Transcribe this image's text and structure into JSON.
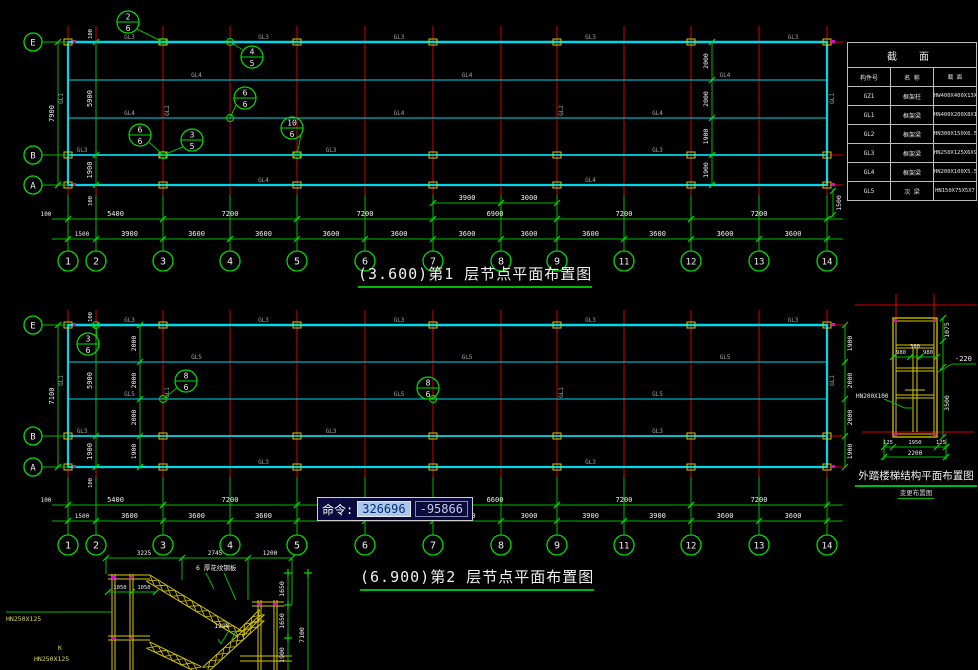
{
  "colors": {
    "grid_red": "#d40000",
    "beam_cyan": "#00d8e8",
    "dim_green": "#00bb00",
    "tick_green": "#00e000",
    "text_white": "#f0f0f0",
    "label_gray": "#a2a2a2",
    "column_yellow": "#d8c800",
    "magenta": "#e000e0",
    "cmd_bg": "#0a0a3e",
    "cmd_select_bg": "#a9c9ea"
  },
  "command_bar": {
    "prompt": "命令:",
    "value_x": "326696",
    "value_y": "-95866"
  },
  "section_table": {
    "title": "截 面",
    "headers": [
      "构件号",
      "名 称",
      "截 面"
    ],
    "rows": [
      [
        "GZ1",
        "框架柱",
        "HW400X400X13X21"
      ],
      [
        "GL1",
        "框架梁",
        "HN400X200X8X13"
      ],
      [
        "GL2",
        "框架梁",
        "HN300X150X6.5X9"
      ],
      [
        "GL3",
        "框架梁",
        "HN250X125X6X9"
      ],
      [
        "GL4",
        "框架梁",
        "HN200X100X5.5X8"
      ],
      [
        "GL5",
        "次 梁",
        "HN150X75X5X7"
      ]
    ]
  },
  "plans": [
    {
      "id": "plan1",
      "title_elevation": "(3.600)",
      "title_text": "第1 层节点平面布置图",
      "axis_labels": [
        "1",
        "2",
        "3",
        "4",
        "5",
        "6",
        "7",
        "8",
        "9",
        "11",
        "12",
        "13",
        "14"
      ],
      "axes_x": [
        68,
        96,
        163,
        230,
        297,
        365,
        433,
        501,
        557,
        624,
        691,
        759,
        827
      ],
      "rows_y": [
        42,
        80,
        118,
        155,
        185
      ],
      "row_labels": [
        {
          "label": "E",
          "row": 0
        },
        {
          "label": "B",
          "row": 3
        },
        {
          "label": "A",
          "row": 4
        }
      ],
      "dims_lower": [
        "1500",
        "3900",
        "3600",
        "3600",
        "3600",
        "3600",
        "3600",
        "3600",
        "3600",
        "3600",
        "3600",
        "3600"
      ],
      "dims_upper": [
        {
          "a": 0,
          "b": 2,
          "t": "5400"
        },
        {
          "a": 2,
          "b": 4,
          "t": "7200"
        },
        {
          "a": 4,
          "b": 6,
          "t": "7200"
        },
        {
          "a": 6,
          "b": 8,
          "t": "6900"
        },
        {
          "a": 8,
          "b": 10,
          "t": "7200"
        },
        {
          "a": 10,
          "b": 12,
          "t": "7200"
        }
      ],
      "dims_extra": [
        {
          "a": 6,
          "b": 7,
          "t": "3900"
        },
        {
          "a": 7,
          "b": 8,
          "t": "3000"
        }
      ],
      "left_total": "7900",
      "left_segs": [
        "5900",
        "1900"
      ],
      "margin_top": "100",
      "margin_bottom": "100",
      "inner_chain": {
        "x": 712,
        "labels": [
          "2000",
          "2000",
          "1900",
          "1900"
        ]
      },
      "right_chain": null,
      "right_below": "1500",
      "beam_top": "GL3",
      "beam_mid": "GL4",
      "beam_b": "GL3",
      "beam_a": "GL4",
      "beam_edge": "GL1",
      "beam_grid": "GL2",
      "column_mark": "GZ1",
      "callouts": [
        {
          "x": 128,
          "y": 22,
          "n": "2",
          "d": "6",
          "tx": 163,
          "ty": 42
        },
        {
          "x": 252,
          "y": 57,
          "n": "4",
          "d": "5",
          "tx": 230,
          "ty": 42
        },
        {
          "x": 245,
          "y": 98,
          "n": "6",
          "d": "6",
          "tx": 230,
          "ty": 118
        },
        {
          "x": 292,
          "y": 128,
          "n": "10",
          "d": "6",
          "tx": 297,
          "ty": 155
        },
        {
          "x": 140,
          "y": 135,
          "n": "6",
          "d": "6",
          "tx": 163,
          "ty": 155
        },
        {
          "x": 192,
          "y": 140,
          "n": "3",
          "d": "5",
          "tx": 163,
          "ty": 155
        }
      ],
      "layout": {
        "dim_extra_y": 203,
        "dim_upper_y": 219,
        "dim_lower_y": 239,
        "bubble_y": 261,
        "grid_top": 26
      }
    },
    {
      "id": "plan2",
      "title_elevation": "(6.900)",
      "title_text": "第2 层节点平面布置图",
      "axis_labels": [
        "1",
        "2",
        "3",
        "4",
        "5",
        "6",
        "7",
        "8",
        "9",
        "11",
        "12",
        "13",
        "14"
      ],
      "axes_x": [
        68,
        96,
        163,
        230,
        297,
        365,
        433,
        501,
        557,
        624,
        691,
        759,
        827
      ],
      "rows_y": [
        325,
        362,
        399,
        436,
        467
      ],
      "row_labels": [
        {
          "label": "E",
          "row": 0
        },
        {
          "label": "B",
          "row": 3
        },
        {
          "label": "A",
          "row": 4
        }
      ],
      "dims_lower": [
        "1500",
        "3600",
        "3600",
        "3600",
        "3600",
        "3600",
        "3600",
        "3000",
        "3900",
        "3900",
        "3600",
        "3600"
      ],
      "dims_upper": [
        {
          "a": 0,
          "b": 2,
          "t": "5400"
        },
        {
          "a": 2,
          "b": 4,
          "t": "7200"
        },
        {
          "a": 4,
          "b": 6,
          "t": "7200"
        },
        {
          "a": 6,
          "b": 8,
          "t": "6600"
        },
        {
          "a": 8,
          "b": 10,
          "t": "7200"
        },
        {
          "a": 10,
          "b": 12,
          "t": "7200"
        }
      ],
      "dims_extra": [],
      "left_total": "7100",
      "left_segs": [
        "5900",
        "1900"
      ],
      "margin_top": "100",
      "margin_bottom": "100",
      "inner_chain": {
        "x": 140,
        "labels": [
          "2000",
          "2000",
          "2000",
          "1900"
        ]
      },
      "right_chain": {
        "x": 845,
        "labels": [
          "1900",
          "2000",
          "2000",
          "1900"
        ]
      },
      "right_below": null,
      "beam_top": "GL3",
      "beam_mid": "GL5",
      "beam_b": "GL3",
      "beam_a": "GL3",
      "beam_edge": "GL1",
      "beam_grid": "GL1",
      "column_mark": "GZ1",
      "callouts": [
        {
          "x": 88,
          "y": 344,
          "n": "3",
          "d": "6",
          "tx": 96,
          "ty": 325
        },
        {
          "x": 186,
          "y": 381,
          "n": "8",
          "d": "6",
          "tx": 163,
          "ty": 399
        },
        {
          "x": 428,
          "y": 388,
          "n": "8",
          "d": "6",
          "tx": 433,
          "ty": 399
        }
      ],
      "layout": {
        "dim_upper_y": 505,
        "dim_lower_y": 521,
        "bubble_y": 545,
        "grid_top": 310
      }
    }
  ],
  "stair_plan": {
    "title": "外踏楼梯结构平面布置图",
    "subtitle": "变更布置图",
    "beam_label": "HN200X100",
    "dims": {
      "top_width": "1075",
      "tread1": "980",
      "mid": "300",
      "tread2": "980",
      "level": "-220",
      "height": "3500",
      "b_left": "125",
      "b_mid": "1950",
      "b_right": "125",
      "b_total": "2200"
    }
  },
  "stair_section": {
    "dims_top": [
      "3225",
      "2745",
      "1200"
    ],
    "dims_inner": [
      "1050",
      "1050"
    ],
    "dim_mid": "1290",
    "dims_right": [
      "1650",
      "1650",
      "1900"
    ],
    "right_total": "7100",
    "note": "6 厚花纹钢板",
    "left_labels": [
      {
        "t": "HN250X125",
        "x": 6,
        "y": 621
      },
      {
        "t": "K",
        "x": 58,
        "y": 650
      },
      {
        "t": "HN250X125",
        "x": 34,
        "y": 661
      }
    ]
  }
}
